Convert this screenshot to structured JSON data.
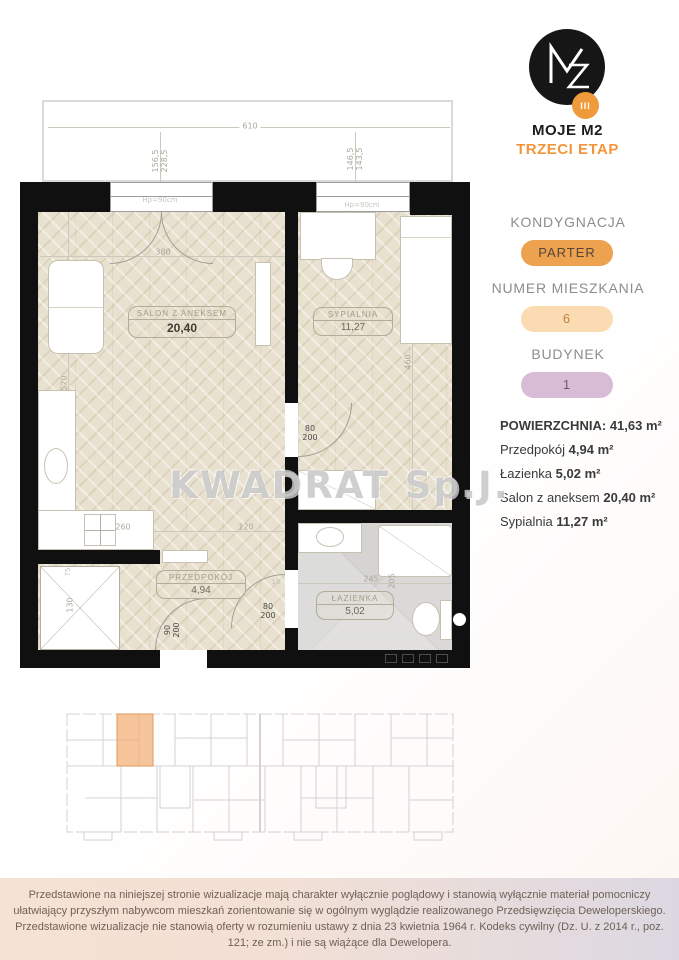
{
  "logo": {
    "monogram": "M2",
    "badge": "III",
    "brand": "MOJE M2",
    "stage": "TRZECI ETAP"
  },
  "panel": {
    "floor_label": "KONDYGNACJA",
    "floor_value": "PARTER",
    "apartment_label": "NUMER MIESZKANIA",
    "apartment_value": "6",
    "building_label": "BUDYNEK",
    "building_value": "1",
    "area_label": "POWIERZCHNIA",
    "colon": ":",
    "area_total": "41,63 m²",
    "rooms": [
      {
        "name": "Przedpokój",
        "value": "4,94 m²"
      },
      {
        "name": "Łazienka",
        "value": "5,02 m²"
      },
      {
        "name": "Salon z aneksem",
        "value": "20,40 m²"
      },
      {
        "name": "Sypialnia",
        "value": "11,27 m²"
      }
    ]
  },
  "plan": {
    "rooms": [
      {
        "name": "SALON Z ANEKSEM",
        "area": "20,40"
      },
      {
        "name": "SYPIALNIA",
        "area": "11,27"
      },
      {
        "name": "PRZEDPOKÓJ",
        "area": "4,94"
      },
      {
        "name": "ŁAZIENKA",
        "area": "5,02"
      }
    ],
    "dims": {
      "total_width": "610",
      "window_left": "156,5\n228,5",
      "window_right": "146,5\n143,5",
      "hp_left": "Hp=90cm",
      "hp_right": "Hp=90cm",
      "salon_w": "380",
      "salon_h": "520",
      "kitchen_w": "260",
      "hall_w": "120",
      "bed_h": "460",
      "shaft_h": "130",
      "shaft_w": "75",
      "bath_w": "245",
      "bath_h": "205",
      "small": "10",
      "door_entry": "90\n200",
      "door_bed": "80\n200",
      "door_bath": "80\n200"
    }
  },
  "watermark": "KWADRAT Sp.J.",
  "footer": "Przedstawione na niniejszej stronie wizualizacje mają charakter wyłącznie poglądowy i stanowią wyłącznie materiał pomocniczy ułatwiający przyszłym nabywcom mieszkań zorientowanie się w ogólnym wyglądzie realizowanego Przedsięwzięcia Deweloperskiego. Przedstawione wizualizacje nie stanowią oferty w rozumieniu ustawy z dnia 23 kwietnia 1964 r. Kodeks cywilny (Dz. U. z 2014 r., poz. 121; ze zm.) i nie są wiążące dla Dewelopera.",
  "colors": {
    "accent_orange": "#f5953b",
    "logo_badge_bg": "#ef9b3c",
    "pill_floor_bg": "#eda250",
    "pill_apartment_bg": "#fbdcb2",
    "pill_building_bg": "#d8bcd5",
    "highlight_unit": "#f2ae76",
    "footer_left": "#f6e2d2",
    "footer_right": "#dcd8e2",
    "wall": "#101010",
    "floor_wood": "#e9e1cf",
    "floor_tile": "#d5d4d2"
  }
}
